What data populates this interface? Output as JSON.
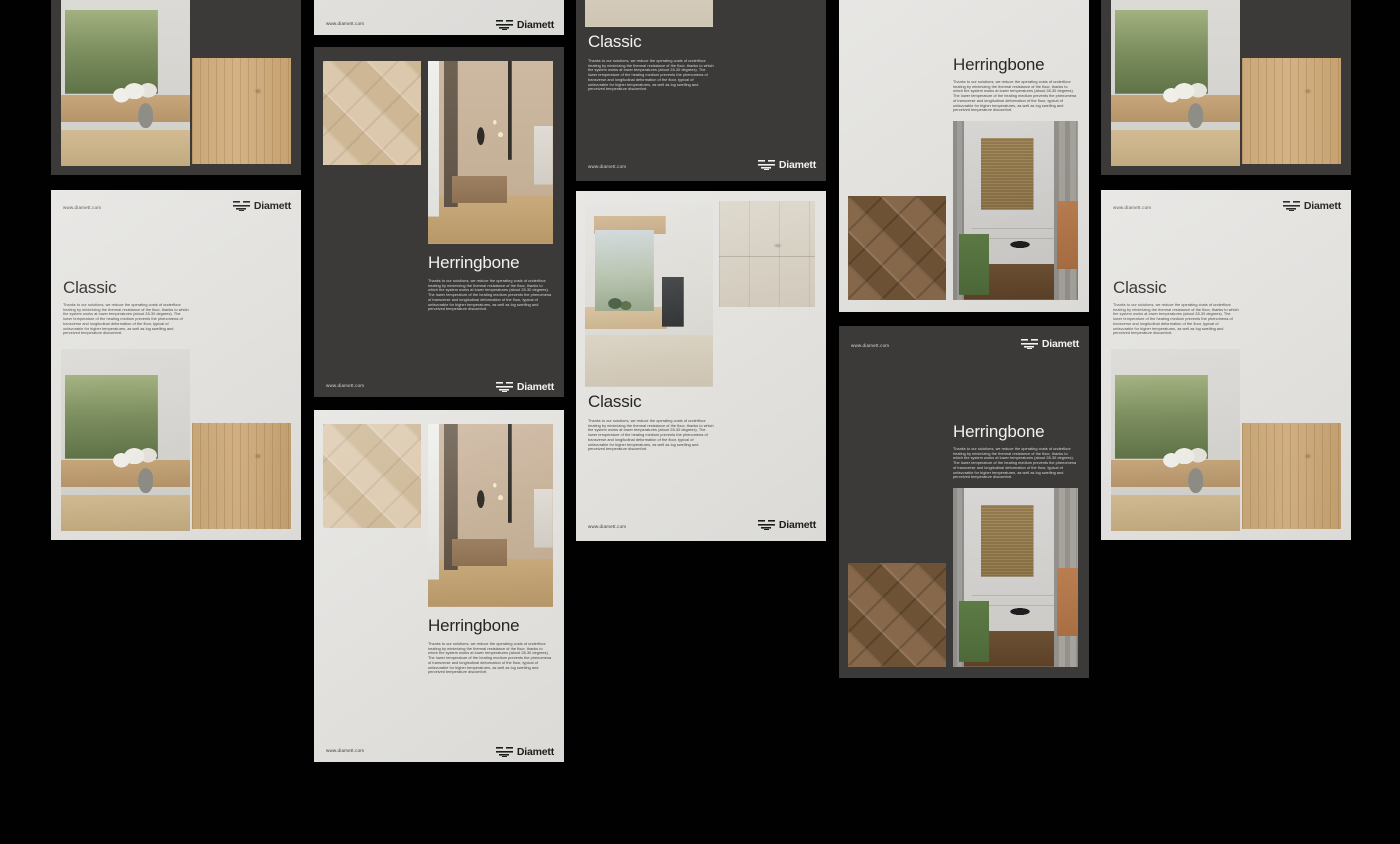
{
  "brand": {
    "name": "Diamett",
    "url": "www.diamett.com",
    "logo_icon": "diamett-layered-planks-mark"
  },
  "text": {
    "classic_title": "Classic",
    "herringbone_title": "Herringbone",
    "body": "Thanks to our solutions, we reduce the operating costs of underfloor heating by minimizing the thermal resistance of the floor, thanks to which the system works at lower temperatures (about 28-30 degrees). The lower temperature of the heating medium prevents the phenomena of transverse and longitudinal deformation of the floor, typical of unfavorable for higher temperatures, as well as log swelling and perceived temperature discomfort."
  },
  "colors": {
    "page_background": "#010101",
    "card_dark": "#3b3a38",
    "card_light": "#e3e2df",
    "oak_wood": "#cba97a",
    "walnut_wood": "#7c6044"
  },
  "cards": [
    {
      "id": "c0",
      "series": "Classic",
      "theme": "dark",
      "partial": true
    },
    {
      "id": "c1",
      "series": "Classic",
      "theme": "light",
      "partial": false
    },
    {
      "id": "c2",
      "series": "Herringbone",
      "theme": "light",
      "partial": true
    },
    {
      "id": "c3",
      "series": "Herringbone",
      "theme": "dark",
      "partial": false
    },
    {
      "id": "c4",
      "series": "Herringbone",
      "theme": "light",
      "partial": false
    },
    {
      "id": "c5",
      "series": "Classic",
      "theme": "dark",
      "partial": true
    },
    {
      "id": "c6",
      "series": "Classic",
      "theme": "light",
      "partial": false
    },
    {
      "id": "c7",
      "series": "Herringbone",
      "theme": "light",
      "partial": true
    },
    {
      "id": "c8",
      "series": "Herringbone",
      "theme": "dark",
      "partial": false
    },
    {
      "id": "c9",
      "series": "Classic",
      "theme": "dark",
      "partial": true
    },
    {
      "id": "c10",
      "series": "Classic",
      "theme": "light",
      "partial": false
    }
  ]
}
